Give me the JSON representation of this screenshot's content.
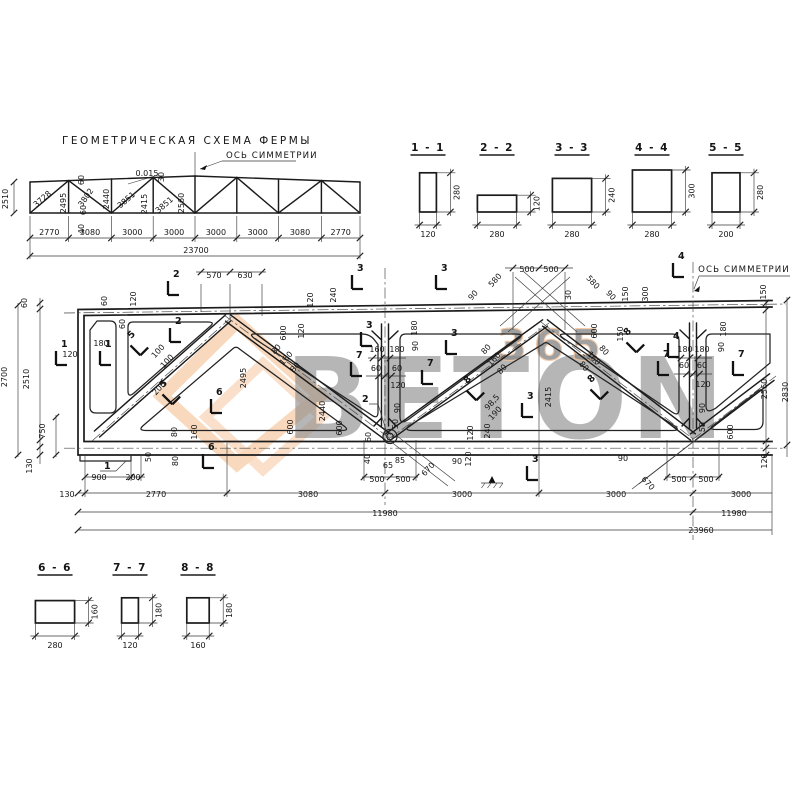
{
  "scheme": {
    "title": "Геометрическая схема фермы",
    "axis_label": "Ось симметрии",
    "panel_dims": [
      "2770",
      "3080",
      "3000",
      "3000",
      "3000",
      "3000",
      "3080",
      "2770"
    ],
    "total_dim": "23700",
    "height_dim": "2510",
    "labels": [
      [
        "2510",
        8,
        199,
        -90
      ],
      [
        "3728",
        44,
        201,
        -41
      ],
      [
        "2495",
        66,
        203,
        -90
      ],
      [
        "3802",
        88,
        199,
        -55
      ],
      [
        "2440",
        109,
        199,
        -90
      ],
      [
        "3851",
        128,
        202,
        -41
      ],
      [
        "2415",
        147,
        204,
        -90
      ],
      [
        "3851",
        166,
        207,
        -41
      ],
      [
        "2560",
        184,
        203,
        -90
      ],
      [
        "60",
        84,
        180,
        -90
      ],
      [
        "0.015",
        147,
        176,
        0
      ],
      [
        "30",
        164,
        177,
        -90
      ],
      [
        "60",
        86,
        210,
        -90
      ],
      [
        "40",
        84,
        229,
        -90
      ]
    ]
  },
  "sections_top": {
    "items": [
      {
        "label": "1 - 1",
        "w": "120",
        "h": "280"
      },
      {
        "label": "2 - 2",
        "w": "280",
        "h": "120"
      },
      {
        "label": "3 - 3",
        "w": "280",
        "h": "240"
      },
      {
        "label": "4 - 4",
        "w": "280",
        "h": "300"
      },
      {
        "label": "5 - 5",
        "w": "200",
        "h": "280"
      }
    ]
  },
  "sections_bottom": {
    "items": [
      {
        "label": "6 - 6",
        "w": "280",
        "h": "160"
      },
      {
        "label": "7 - 7",
        "w": "120",
        "h": "180"
      },
      {
        "label": "8 - 8",
        "w": "160",
        "h": "180"
      }
    ]
  },
  "main": {
    "axis_label": "Ось симметрии",
    "callout_1": "1",
    "callout_2": "2",
    "labels": [
      [
        "60",
        27,
        303,
        -90
      ],
      [
        "2700",
        7,
        377,
        -90
      ],
      [
        "2510",
        29,
        379,
        -90
      ],
      [
        "750",
        45,
        431,
        -90
      ],
      [
        "130",
        32,
        466,
        -90
      ],
      [
        "570",
        214,
        278,
        0
      ],
      [
        "630",
        245,
        278,
        0
      ],
      [
        "60",
        107,
        301,
        -90
      ],
      [
        "120",
        136,
        299,
        -90
      ],
      [
        "60",
        125,
        324,
        -90
      ],
      [
        "180",
        101,
        346,
        0
      ],
      [
        "120",
        70,
        357,
        0
      ],
      [
        "100",
        160,
        353,
        -48
      ],
      [
        "100",
        169,
        363,
        -48
      ],
      [
        "200",
        161,
        390,
        -48
      ],
      [
        "2495",
        246,
        378,
        -90
      ],
      [
        "600",
        286,
        333,
        -90
      ],
      [
        "120",
        304,
        331,
        -90
      ],
      [
        "80",
        278,
        351,
        -48
      ],
      [
        "160",
        288,
        360,
        -48
      ],
      [
        "80",
        297,
        369,
        -48
      ],
      [
        "120",
        313,
        300,
        -90
      ],
      [
        "240",
        336,
        295,
        -90
      ],
      [
        "160",
        377,
        352,
        0
      ],
      [
        "180",
        397,
        352,
        0
      ],
      [
        "180",
        417,
        328,
        -90
      ],
      [
        "90",
        418,
        346,
        -90
      ],
      [
        "60",
        376,
        371,
        0
      ],
      [
        "60",
        397,
        371,
        0
      ],
      [
        "120",
        398,
        388,
        0
      ],
      [
        "2440",
        325,
        411,
        -90
      ],
      [
        "90",
        400,
        408,
        -90
      ],
      [
        "50",
        398,
        424,
        -90
      ],
      [
        "600",
        293,
        427,
        -90
      ],
      [
        "600",
        342,
        428,
        -90
      ],
      [
        "60",
        371,
        437,
        -90
      ],
      [
        "40",
        370,
        459,
        -90
      ],
      [
        "65",
        388,
        468,
        0
      ],
      [
        "85",
        400,
        463,
        0
      ],
      [
        "670",
        430,
        471,
        -48
      ],
      [
        "90",
        457,
        464,
        0
      ],
      [
        "120",
        471,
        459,
        -90
      ],
      [
        "120",
        473,
        433,
        -90
      ],
      [
        "240",
        490,
        431,
        -90
      ],
      [
        "500",
        377,
        482,
        0
      ],
      [
        "500",
        403,
        482,
        0
      ],
      [
        "900",
        99,
        480,
        0
      ],
      [
        "200",
        133,
        480,
        0
      ],
      [
        "50",
        151,
        457,
        -90
      ],
      [
        "80",
        178,
        461,
        -90
      ],
      [
        "80",
        177,
        432,
        -90
      ],
      [
        "160",
        197,
        432,
        -90
      ],
      [
        "130",
        67,
        497,
        0
      ],
      [
        "2770",
        156,
        497,
        0
      ],
      [
        "3080",
        308,
        497,
        0
      ],
      [
        "3000",
        462,
        497,
        0
      ],
      [
        "3000",
        616,
        497,
        0
      ],
      [
        "3000",
        741,
        497,
        0
      ],
      [
        "11980",
        385,
        516,
        0
      ],
      [
        "11980",
        734,
        516,
        0
      ],
      [
        "23960",
        701,
        533,
        0
      ],
      [
        "500",
        527,
        272,
        0
      ],
      [
        "500",
        551,
        272,
        0
      ],
      [
        "580",
        497,
        282,
        -48
      ],
      [
        "90",
        475,
        297,
        -48
      ],
      [
        "580",
        591,
        284,
        48
      ],
      [
        "30",
        571,
        295,
        -90
      ],
      [
        "90",
        609,
        297,
        48
      ],
      [
        "150",
        628,
        294,
        -90
      ],
      [
        "300",
        648,
        294,
        -90
      ],
      [
        "150",
        766,
        292,
        -90
      ],
      [
        "600",
        597,
        331,
        -90
      ],
      [
        "150",
        623,
        334,
        -90
      ],
      [
        "80",
        488,
        351,
        -48
      ],
      [
        "160",
        496,
        361,
        -48
      ],
      [
        "80",
        504,
        371,
        -48
      ],
      [
        "98,5",
        494,
        404,
        -48
      ],
      [
        "190",
        497,
        415,
        -48
      ],
      [
        "2415",
        551,
        397,
        -90
      ],
      [
        "80",
        582,
        368,
        48
      ],
      [
        "160",
        592,
        360,
        48
      ],
      [
        "80",
        602,
        352,
        48
      ],
      [
        "180",
        685,
        352,
        0
      ],
      [
        "180",
        702,
        352,
        0
      ],
      [
        "90",
        724,
        347,
        -90
      ],
      [
        "180",
        726,
        329,
        -90
      ],
      [
        "60",
        684,
        368,
        0
      ],
      [
        "60",
        702,
        368,
        0
      ],
      [
        "120",
        703,
        387,
        0
      ],
      [
        "90",
        705,
        408,
        -90
      ],
      [
        "50",
        705,
        427,
        -90
      ],
      [
        "600",
        733,
        432,
        -90
      ],
      [
        "670",
        646,
        485,
        48
      ],
      [
        "90",
        623,
        461,
        0
      ],
      [
        "500",
        679,
        482,
        0
      ],
      [
        "500",
        706,
        482,
        0
      ],
      [
        "2560",
        767,
        389,
        -90
      ],
      [
        "2830",
        788,
        392,
        -90
      ],
      [
        "120",
        767,
        461,
        -90
      ]
    ],
    "marks": [
      [
        "1",
        56,
        356,
        0
      ],
      [
        "1",
        100,
        356,
        0
      ],
      [
        "2",
        168,
        286,
        0
      ],
      [
        "2",
        170,
        333,
        0
      ],
      [
        "3",
        352,
        280,
        0
      ],
      [
        "3",
        361,
        337,
        0
      ],
      [
        "3",
        436,
        280,
        0
      ],
      [
        "3",
        446,
        345,
        0
      ],
      [
        "3",
        522,
        408,
        0
      ],
      [
        "3",
        527,
        471,
        0
      ],
      [
        "4",
        673,
        268,
        0
      ],
      [
        "4",
        668,
        348,
        0
      ],
      [
        "5",
        134,
        349,
        -45
      ],
      [
        "5",
        166,
        398,
        -45
      ],
      [
        "6",
        211,
        404,
        0
      ],
      [
        "6",
        203,
        459,
        0
      ],
      [
        "7",
        351,
        367,
        0
      ],
      [
        "7",
        422,
        375,
        0
      ],
      [
        "7",
        658,
        366,
        0
      ],
      [
        "7",
        733,
        366,
        0
      ],
      [
        "8",
        630,
        346,
        -45
      ],
      [
        "8",
        594,
        393,
        -45
      ],
      [
        "8",
        470,
        394,
        -45
      ]
    ]
  },
  "watermark": {
    "word": "BETON",
    "digits": "365",
    "orange": "#e8832f",
    "orange_light": "#f3a869",
    "gray": "#e4e8e3"
  }
}
